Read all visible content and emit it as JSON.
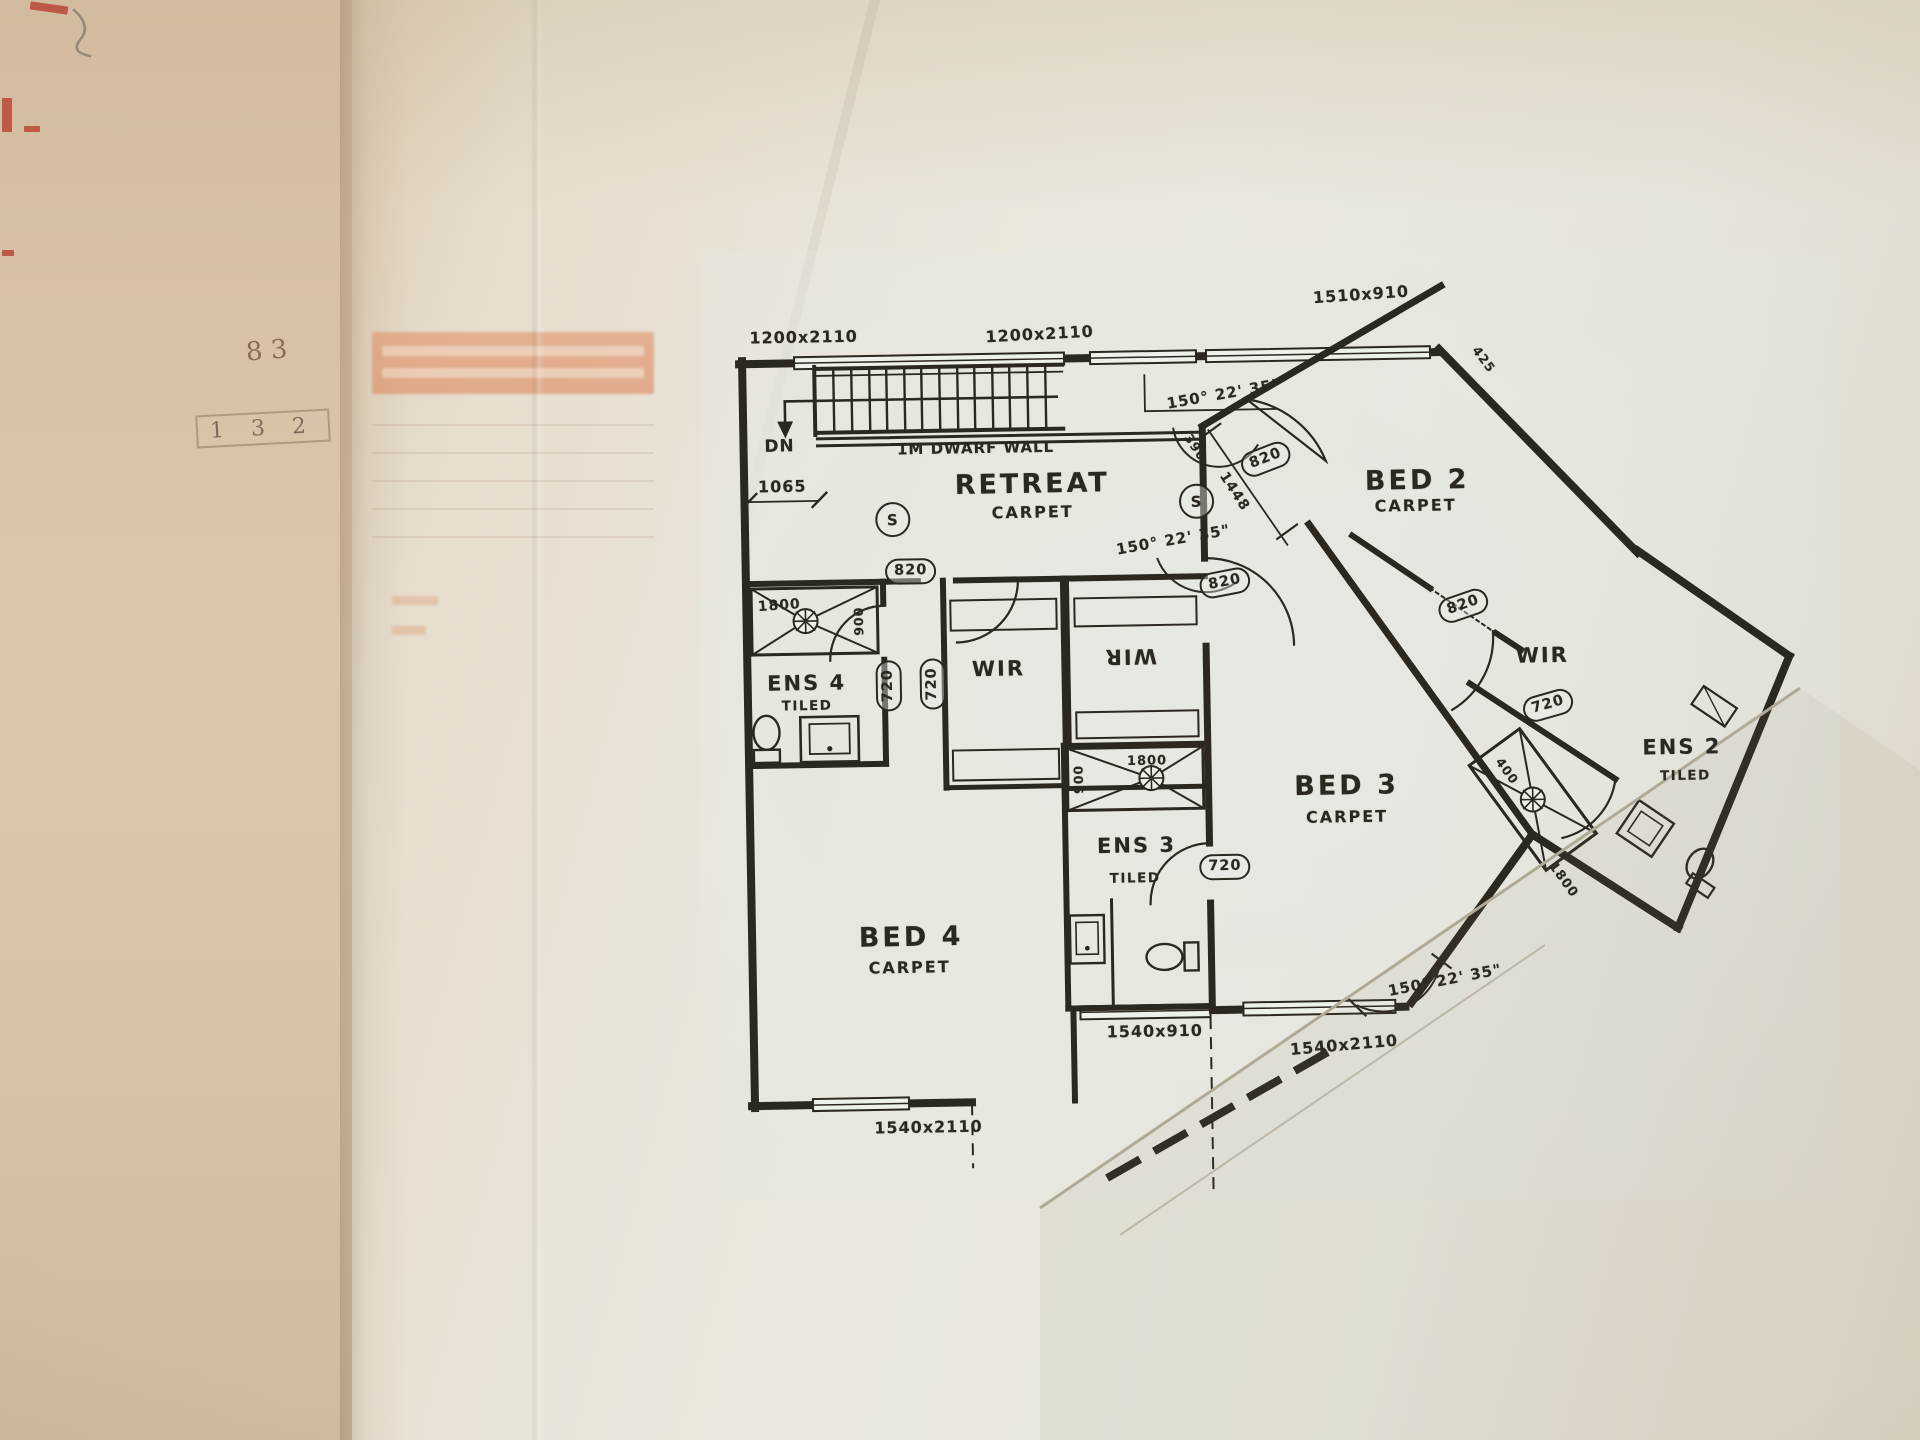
{
  "plan": {
    "stair": {
      "down_label": "DN",
      "dwarf_wall_note": "1M DWARF WALL",
      "offset_dim": "1065"
    },
    "rooms": {
      "retreat": {
        "name": "RETREAT",
        "finish": "CARPET"
      },
      "bed2": {
        "name": "BED 2",
        "finish": "CARPET"
      },
      "bed3": {
        "name": "BED 3",
        "finish": "CARPET"
      },
      "bed4": {
        "name": "BED 4",
        "finish": "CARPET"
      },
      "ens2": {
        "name": "ENS 2",
        "finish": "TILED"
      },
      "ens3": {
        "name": "ENS 3",
        "finish": "TILED"
      },
      "ens4": {
        "name": "ENS 4",
        "finish": "TILED"
      },
      "wir_left": {
        "name": "WIR"
      },
      "wir_mid": {
        "name": "WIR"
      },
      "wir_right": {
        "name": "WIR"
      }
    },
    "windows": {
      "top_left": "1200x2110",
      "top_mid": "1200x2110",
      "top_right": "1510x910",
      "entry": "1540x910",
      "bed3": "1540x2110",
      "bottom_left": "1540x2110"
    },
    "doors": {
      "d820": "820",
      "d720": "720"
    },
    "angles": {
      "note": "150° 22' 35\""
    },
    "dims": {
      "d390": "390",
      "d1448": "1448",
      "d425": "425",
      "ens4_shower_w": "1800",
      "ens4_shower_d": "900",
      "ens3_shower_w": "1800",
      "ens3_shower_d": "900",
      "ens2_shower_w": "1800",
      "ens2_shower_d": "400"
    },
    "symbols": {
      "smoke": "S"
    }
  },
  "side_page": {
    "note_top": "8 3",
    "note_boxed": "1 3 2"
  }
}
